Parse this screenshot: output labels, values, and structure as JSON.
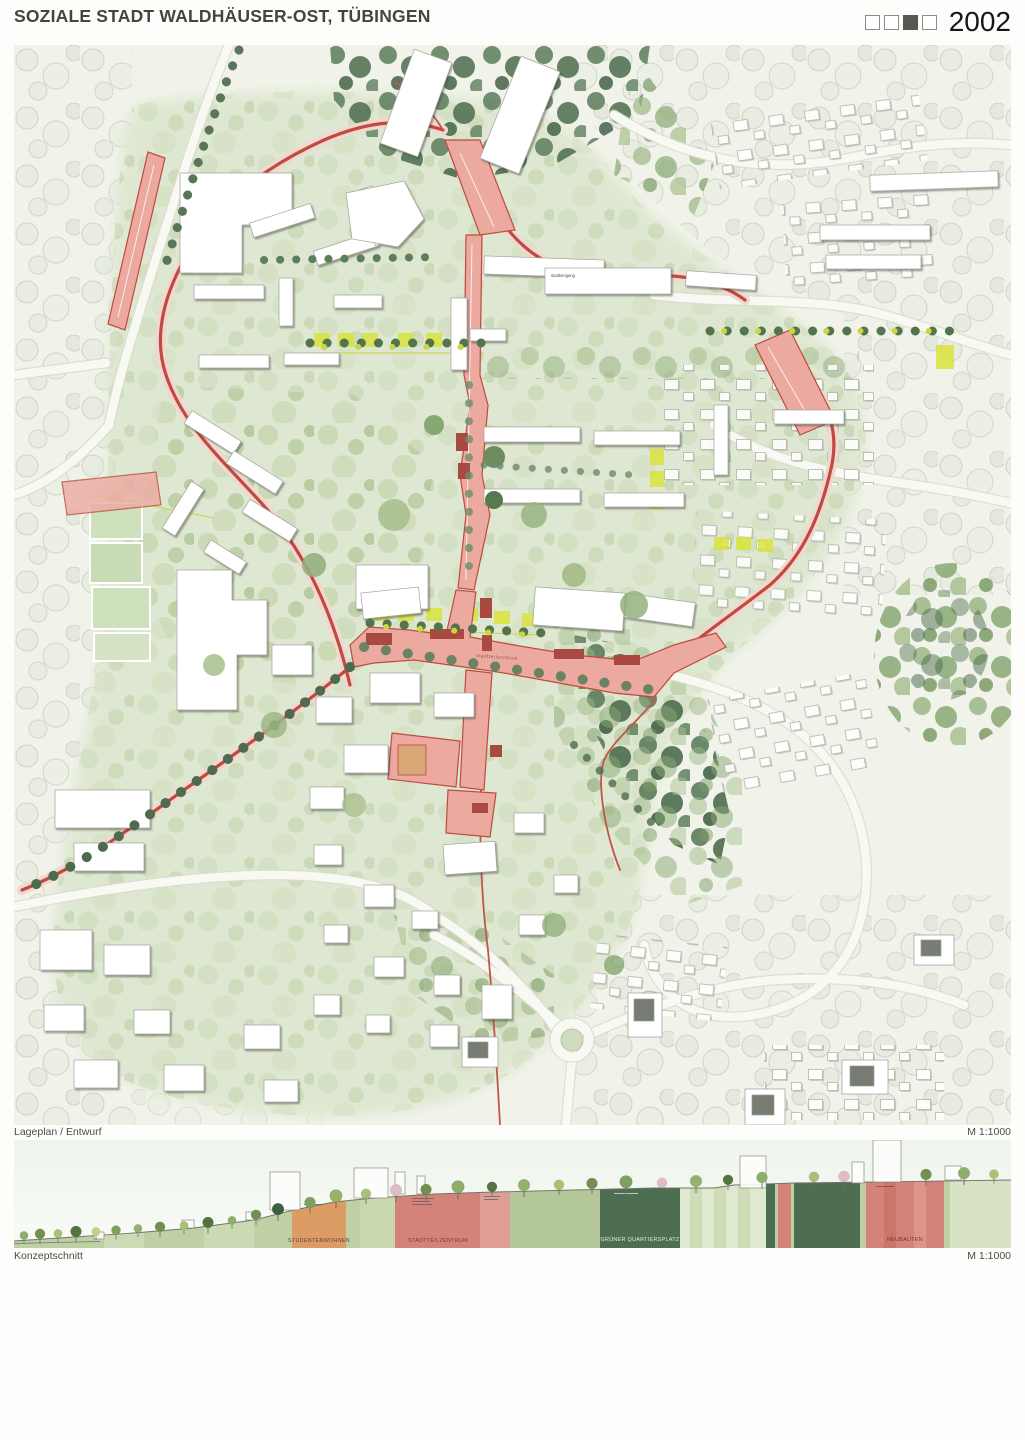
{
  "header": {
    "title": "SOZIALE STADT WALDHÄUSER-OST, TÜBINGEN",
    "year": "2002",
    "phase_boxes": {
      "count": 4,
      "filled_index": 3
    }
  },
  "plan": {
    "caption": "Lageplan / Entwurf",
    "scale": "M 1:1000",
    "labels": {
      "stadteingang": "stadteingang",
      "zentrum": "stadtteilzentrum"
    }
  },
  "section": {
    "caption": "Konzeptschnitt",
    "scale": "M 1:1000",
    "bands": [
      {
        "label": "STUDENTENWOHNEN",
        "color": "#dd9c63"
      },
      {
        "label": "STADTTEILZENTRUM",
        "color": "#d4837b"
      },
      {
        "label": "GRÜNER QUARTIERSPLATZ",
        "color": "#4e6e52"
      },
      {
        "label": "NEUBAUTEN",
        "color": "#d4837b"
      }
    ]
  },
  "colors": {
    "road_red": "#bf4a3f",
    "plaza_pink": "#e9a89f",
    "accent_yellow": "#d9e33c",
    "green_light": "#dde6cf",
    "green_dark": "#4e6e52"
  }
}
